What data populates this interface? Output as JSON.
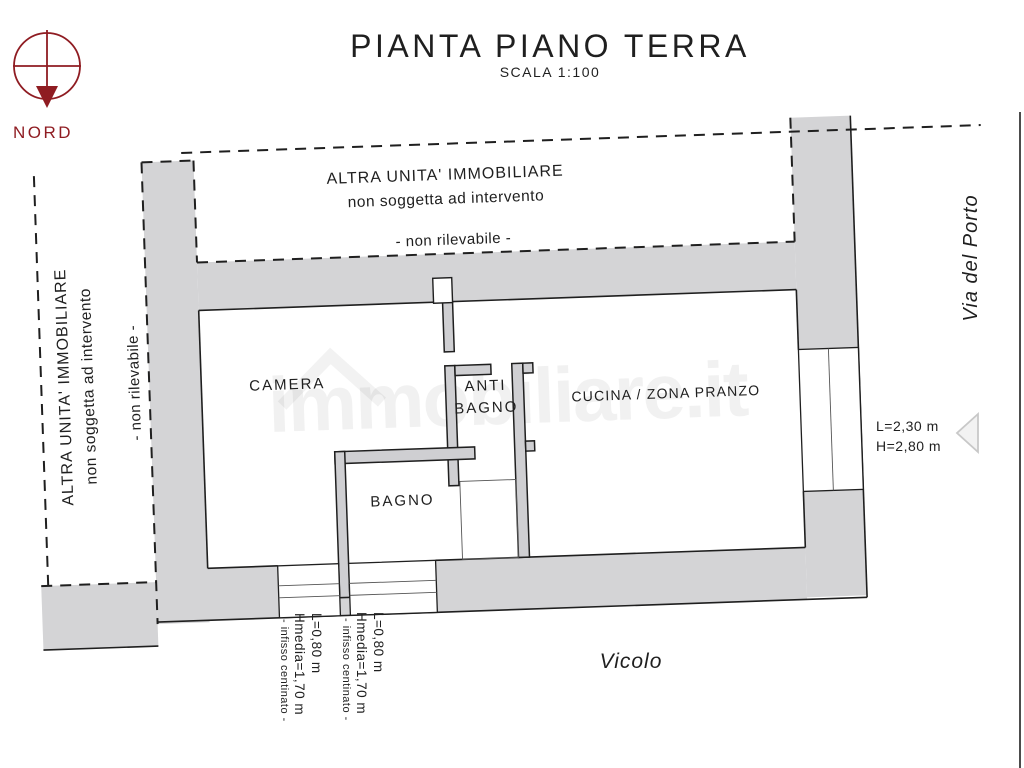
{
  "colors": {
    "line": "#1f1f1f",
    "wall": "#d4d4d6",
    "accent-red": "#8f1c22",
    "paper": "#ffffff"
  },
  "title": {
    "main": "PIANTA PIANO TERRA",
    "scale": "SCALA 1:100"
  },
  "north": {
    "label": "NORD"
  },
  "other_unit": {
    "line1": "ALTRA UNITA' IMMOBILIARE",
    "line2": "non soggetta ad intervento",
    "note": "- non rilevabile -"
  },
  "rooms": {
    "camera": "CAMERA",
    "anti_bagno_line1": "ANTI",
    "anti_bagno_line2": "BAGNO",
    "bagno": "BAGNO",
    "cucina": "CUCINA / ZONA PRANZO"
  },
  "streets": {
    "right": "Via del Porto",
    "bottom": "Vicolo"
  },
  "window_right": {
    "width": "L=2,30 m",
    "height": "H=2,80 m"
  },
  "window_bottom": {
    "width": "L=0,80 m",
    "height": "Hmedia=1,70 m",
    "note": "- infisso centinato -"
  },
  "watermark": {
    "text": "immobiliare.it"
  }
}
